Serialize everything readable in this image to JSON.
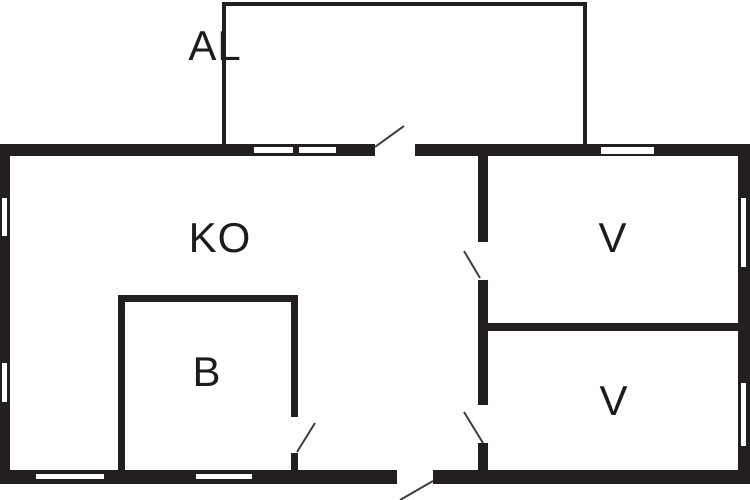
{
  "plan": {
    "width": 750,
    "height": 500
  },
  "palette": {
    "wall": "#231f20",
    "background": "#ffffff",
    "window_fill": "#ffffff",
    "swing_line": "#3d3d3d",
    "label": "#1c1c1c"
  },
  "rooms": [
    {
      "id": "al",
      "label": "AL",
      "cx": 215,
      "cy": 46
    },
    {
      "id": "ko",
      "label": "KO",
      "cx": 220,
      "cy": 238
    },
    {
      "id": "b",
      "label": "B",
      "cx": 207,
      "cy": 372
    },
    {
      "id": "v-upper",
      "label": "V",
      "cx": 613,
      "cy": 238
    },
    {
      "id": "v-lower",
      "label": "V",
      "cx": 614,
      "cy": 401
    }
  ],
  "walls": [
    {
      "id": "outer-top",
      "x": 0,
      "y": 144,
      "w": 750,
      "h": 12
    },
    {
      "id": "outer-bottom",
      "x": 0,
      "y": 470,
      "w": 750,
      "h": 14
    },
    {
      "id": "outer-left",
      "x": 0,
      "y": 144,
      "w": 10,
      "h": 340
    },
    {
      "id": "outer-right",
      "x": 738,
      "y": 144,
      "w": 12,
      "h": 340
    },
    {
      "id": "al-top",
      "x": 222,
      "y": 2,
      "w": 365,
      "h": 4
    },
    {
      "id": "al-left",
      "x": 222,
      "y": 2,
      "w": 4,
      "h": 142
    },
    {
      "id": "al-right",
      "x": 583,
      "y": 2,
      "w": 4,
      "h": 142
    },
    {
      "id": "ko-v-divider",
      "x": 478,
      "y": 156,
      "w": 10,
      "h": 314
    },
    {
      "id": "v-v-divider",
      "x": 488,
      "y": 323,
      "w": 250,
      "h": 8
    },
    {
      "id": "b-top",
      "x": 118,
      "y": 295,
      "w": 180,
      "h": 7
    },
    {
      "id": "b-left",
      "x": 118,
      "y": 302,
      "w": 7,
      "h": 168
    },
    {
      "id": "b-right",
      "x": 291,
      "y": 302,
      "w": 7,
      "h": 168
    }
  ],
  "door_gaps": [
    {
      "id": "door-ko-al",
      "x": 375,
      "y": 143,
      "w": 40,
      "h": 15
    },
    {
      "id": "door-ko-outside",
      "x": 397,
      "y": 469,
      "w": 36,
      "h": 16
    },
    {
      "id": "door-ko-v-upper",
      "x": 477,
      "y": 242,
      "w": 12,
      "h": 38
    },
    {
      "id": "door-ko-v-lower",
      "x": 477,
      "y": 405,
      "w": 12,
      "h": 38
    },
    {
      "id": "door-b",
      "x": 289,
      "y": 417,
      "w": 11,
      "h": 36
    }
  ],
  "windows": [
    {
      "id": "win-top-al-1",
      "x": 253,
      "y": 146,
      "w": 41,
      "h": 8
    },
    {
      "id": "win-top-al-2",
      "x": 298,
      "y": 146,
      "w": 39,
      "h": 8
    },
    {
      "id": "win-top-v",
      "x": 600,
      "y": 146,
      "w": 55,
      "h": 9
    },
    {
      "id": "win-left-1",
      "x": 1,
      "y": 197,
      "w": 7,
      "h": 40
    },
    {
      "id": "win-left-2",
      "x": 1,
      "y": 362,
      "w": 7,
      "h": 41
    },
    {
      "id": "win-right-1",
      "x": 740,
      "y": 197,
      "w": 7,
      "h": 71
    },
    {
      "id": "win-right-2",
      "x": 740,
      "y": 382,
      "w": 7,
      "h": 65
    },
    {
      "id": "win-bottom-1",
      "x": 35,
      "y": 473,
      "w": 70,
      "h": 7
    },
    {
      "id": "win-bottom-2",
      "x": 195,
      "y": 473,
      "w": 58,
      "h": 7
    }
  ],
  "door_swings": [
    {
      "id": "swing-ko-al",
      "x1": 375,
      "y1": 147,
      "x2": 404,
      "y2": 126
    },
    {
      "id": "swing-ko-outside",
      "x1": 433,
      "y1": 481,
      "x2": 400,
      "y2": 500
    },
    {
      "id": "swing-ko-v-upper",
      "x1": 464,
      "y1": 251,
      "x2": 480,
      "y2": 278
    },
    {
      "id": "swing-ko-v-lower",
      "x1": 464,
      "y1": 412,
      "x2": 483,
      "y2": 443
    },
    {
      "id": "swing-b",
      "x1": 297,
      "y1": 452,
      "x2": 315,
      "y2": 423
    }
  ]
}
